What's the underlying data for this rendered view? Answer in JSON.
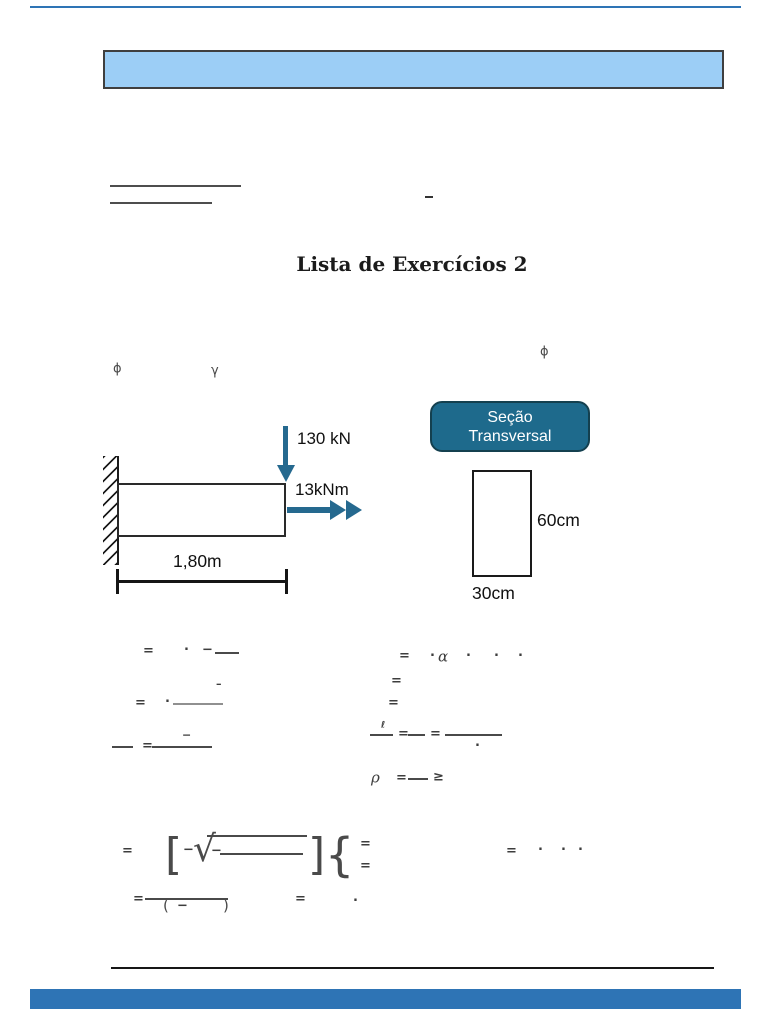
{
  "document": {
    "title": "Lista de Exercícios 2"
  },
  "decor": {
    "top_line_color": "#2E74B5",
    "banner_fill": "#9CCEF6",
    "banner_border": "#3F3F3F",
    "bottom_bar_color": "#2E74B5"
  },
  "beam": {
    "load_label": "130 kN",
    "moment_label": "13kNm",
    "length_label": "1,80m",
    "arrow_color": "#25698F"
  },
  "section": {
    "box_label_line1": "Seção",
    "box_label_line2": "Transversal",
    "box_fill": "#1E6A8C",
    "height_label": "60cm",
    "width_label": "30cm"
  },
  "formulas": {
    "fragments": [
      {
        "g": "ϕ",
        "x": 113,
        "y": 369,
        "s": 13,
        "cls": "thin"
      },
      {
        "g": "γ",
        "x": 211,
        "y": 371,
        "s": 13,
        "cls": "thin"
      },
      {
        "g": "ϕ",
        "x": 540,
        "y": 352,
        "s": 13,
        "cls": "thin"
      },
      {
        "g": "=",
        "x": 143,
        "y": 651
      },
      {
        "g": "·",
        "x": 184,
        "y": 650
      },
      {
        "g": "−",
        "x": 202,
        "y": 650
      },
      {
        "g": "–",
        "x": 216,
        "y": 684,
        "s": 11
      },
      {
        "g": "=",
        "x": 135,
        "y": 703
      },
      {
        "g": "·",
        "x": 165,
        "y": 702
      },
      {
        "g": "−",
        "x": 182,
        "y": 735,
        "s": 11
      },
      {
        "g": "=",
        "x": 142,
        "y": 746
      },
      {
        "g": "=",
        "x": 399,
        "y": 656
      },
      {
        "g": "·",
        "x": 430,
        "y": 656
      },
      {
        "g": "α",
        "x": 438,
        "y": 657,
        "s": 15,
        "cls": "it"
      },
      {
        "g": "·",
        "x": 466,
        "y": 656
      },
      {
        "g": "·",
        "x": 494,
        "y": 656
      },
      {
        "g": "·",
        "x": 518,
        "y": 656
      },
      {
        "g": "=",
        "x": 391,
        "y": 681
      },
      {
        "g": "=",
        "x": 388,
        "y": 703
      },
      {
        "g": "ℓ",
        "x": 381,
        "y": 726,
        "s": 9
      },
      {
        "g": "=",
        "x": 398,
        "y": 734
      },
      {
        "g": "=",
        "x": 430,
        "y": 734
      },
      {
        "g": "·",
        "x": 475,
        "y": 746
      },
      {
        "g": "ρ",
        "x": 371,
        "y": 778,
        "s": 15,
        "cls": "it"
      },
      {
        "g": "=",
        "x": 396,
        "y": 778
      },
      {
        "g": "≥",
        "x": 433,
        "y": 777,
        "s": 13
      },
      {
        "g": "=",
        "x": 122,
        "y": 851
      },
      {
        "g": "[",
        "x": 165,
        "y": 855,
        "cls": "big"
      },
      {
        "g": "−",
        "x": 183,
        "y": 850
      },
      {
        "g": "√",
        "x": 193,
        "y": 850,
        "cls": "rad"
      },
      {
        "g": "−",
        "x": 211,
        "y": 851
      },
      {
        "g": "]",
        "x": 308,
        "y": 855,
        "cls": "big"
      },
      {
        "g": "{",
        "x": 325,
        "y": 855,
        "cls": "big2"
      },
      {
        "g": "=",
        "x": 360,
        "y": 844
      },
      {
        "g": "=",
        "x": 360,
        "y": 866
      },
      {
        "g": "=",
        "x": 506,
        "y": 851
      },
      {
        "g": "·",
        "x": 538,
        "y": 850
      },
      {
        "g": "·",
        "x": 561,
        "y": 850
      },
      {
        "g": "·",
        "x": 578,
        "y": 850
      },
      {
        "g": "=",
        "x": 133,
        "y": 899
      },
      {
        "g": "(",
        "x": 163,
        "y": 906,
        "s": 15,
        "cls": "thin"
      },
      {
        "g": "−",
        "x": 177,
        "y": 906
      },
      {
        "g": ")",
        "x": 223,
        "y": 906,
        "s": 15,
        "cls": "thin"
      },
      {
        "g": "=",
        "x": 295,
        "y": 899
      },
      {
        "g": "·",
        "x": 353,
        "y": 901
      }
    ],
    "bars": [
      {
        "x": 215,
        "y": 652,
        "w": 24
      },
      {
        "x": 173,
        "y": 703,
        "w": 50,
        "c": "#909090"
      },
      {
        "x": 112,
        "y": 746,
        "w": 21
      },
      {
        "x": 152,
        "y": 746,
        "w": 60
      },
      {
        "x": 370,
        "y": 734,
        "w": 23
      },
      {
        "x": 408,
        "y": 734,
        "w": 17
      },
      {
        "x": 445,
        "y": 734,
        "w": 57
      },
      {
        "x": 408,
        "y": 778,
        "w": 20
      },
      {
        "x": 207,
        "y": 835,
        "w": 100
      },
      {
        "x": 220,
        "y": 853,
        "w": 83
      },
      {
        "x": 145,
        "y": 898,
        "w": 83,
        "h": 2
      }
    ]
  }
}
